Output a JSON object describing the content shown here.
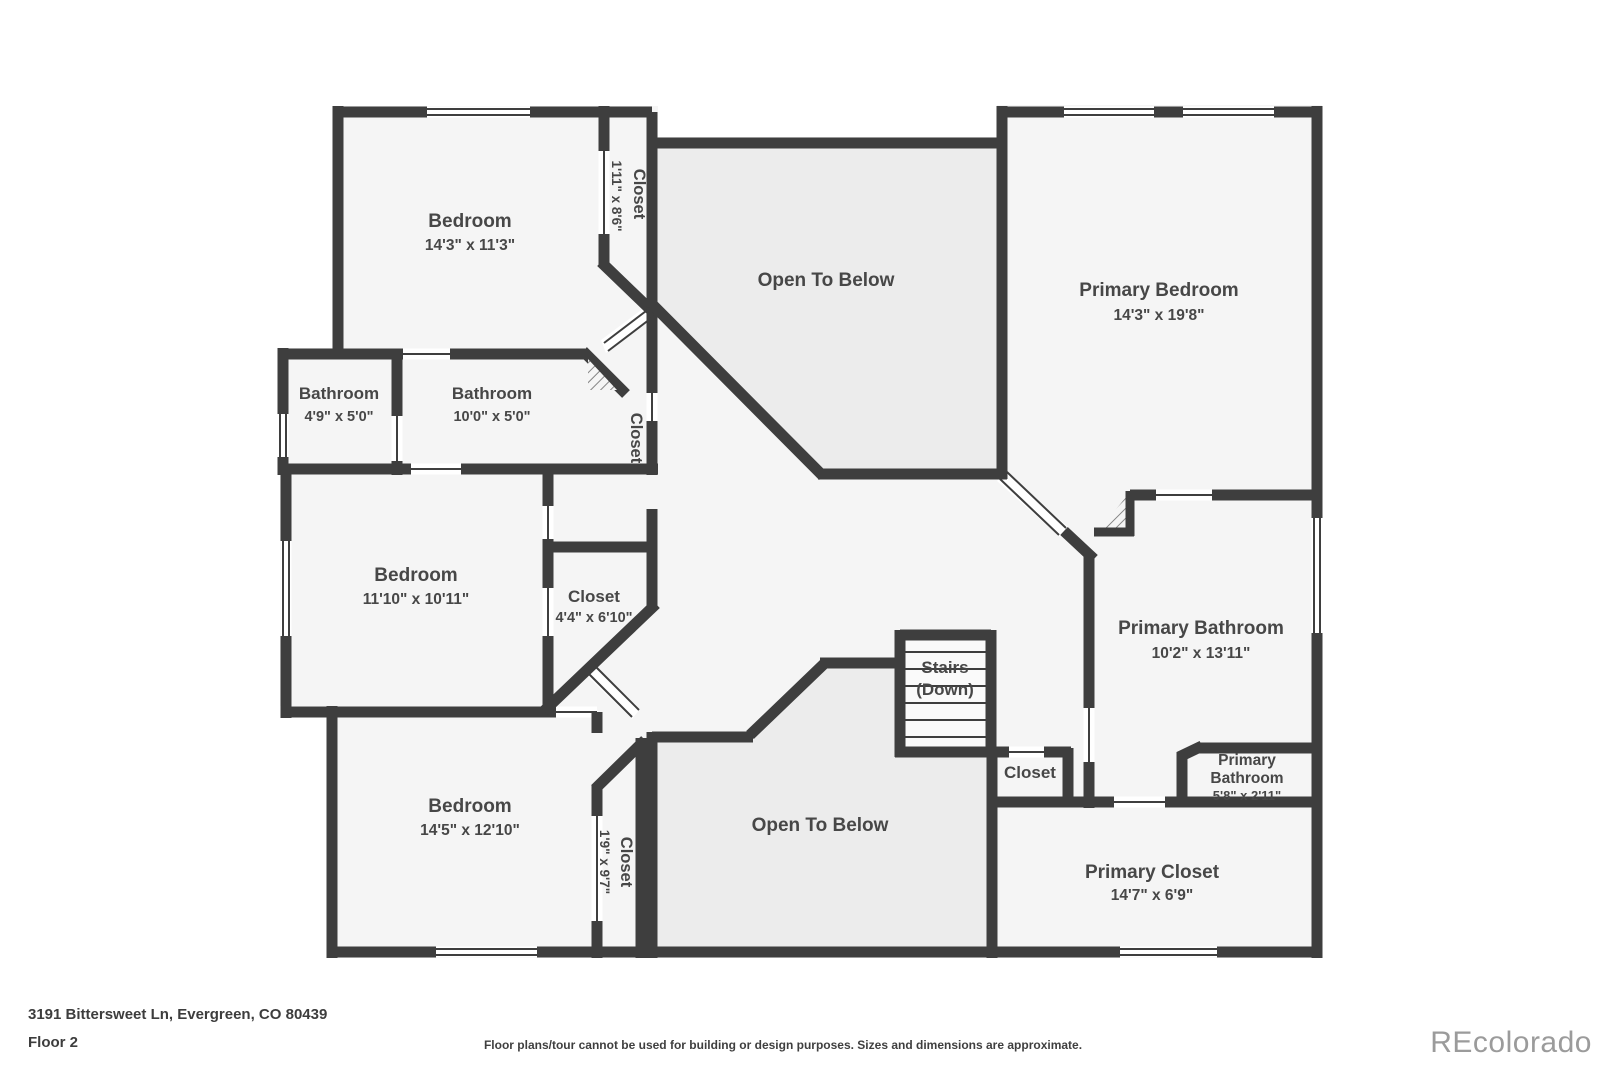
{
  "title": "Floor plan - Floor 2",
  "rooms": [
    {
      "id": "bedroom-top-left",
      "name": "Bedroom",
      "dims": "14'3\" x 11'3\""
    },
    {
      "id": "closet-top",
      "name": "Closet",
      "dims": "1'11\" x 8'6\""
    },
    {
      "id": "open-to-below-top",
      "name": "Open To Below",
      "dims": ""
    },
    {
      "id": "primary-bedroom",
      "name": "Primary Bedroom",
      "dims": "14'3\" x 19'8\""
    },
    {
      "id": "bathroom-small",
      "name": "Bathroom",
      "dims": "4'9\" x 5'0\""
    },
    {
      "id": "bathroom-hall",
      "name": "Bathroom",
      "dims": "10'0\" x 5'0\""
    },
    {
      "id": "closet-bath",
      "name": "Closet",
      "dims": ""
    },
    {
      "id": "bedroom-mid-left",
      "name": "Bedroom",
      "dims": "11'10\" x 10'11\""
    },
    {
      "id": "closet-mid",
      "name": "Closet",
      "dims": "4'4\" x 6'10\""
    },
    {
      "id": "stairs",
      "name": "Stairs",
      "dims": "(Down)"
    },
    {
      "id": "closet-stairs",
      "name": "Closet",
      "dims": ""
    },
    {
      "id": "primary-bathroom",
      "name": "Primary Bathroom",
      "dims": "10'2\" x 13'11\""
    },
    {
      "id": "primary-bathroom-small",
      "name": "Primary",
      "name2": "Bathroom",
      "dims": "5'8\" x 2'11\""
    },
    {
      "id": "bedroom-bottom-left",
      "name": "Bedroom",
      "dims": "14'5\" x 12'10\""
    },
    {
      "id": "closet-bottom",
      "name": "Closet",
      "dims": "1'9\" x 9'7\""
    },
    {
      "id": "open-to-below-bottom",
      "name": "Open To Below",
      "dims": ""
    },
    {
      "id": "primary-closet",
      "name": "Primary Closet",
      "dims": "14'7\" x 6'9\""
    }
  ],
  "footer": {
    "address": "3191 Bittersweet Ln, Evergreen, CO 80439",
    "floor": "Floor 2",
    "disclaimer": "Floor plans/tour cannot be used for building or design purposes. Sizes and dimensions are approximate."
  },
  "watermark": "REcolorado",
  "colors": {
    "wall": "#3e3e3e",
    "floor_fill": "#f5f5f5",
    "open_to_below_fill": "#ececec",
    "stairs_fill": "#fafafa",
    "label_text": "#474747",
    "footer_text": "#3d3d3d",
    "watermark_text": "#9b9b9b",
    "background": "#ffffff"
  }
}
